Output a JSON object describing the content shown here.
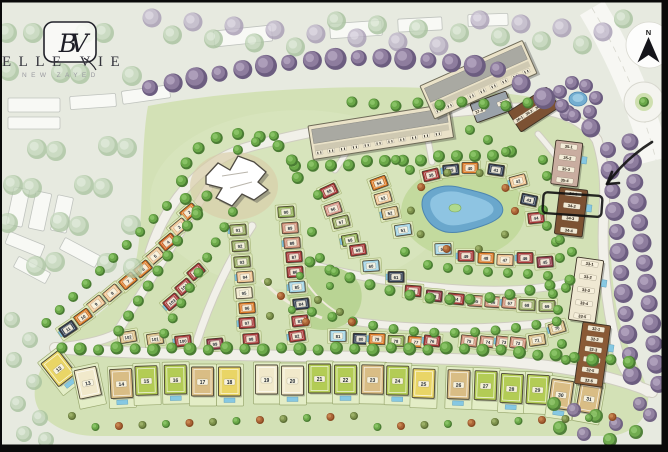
{
  "branding": {
    "title": "ELLE VIE",
    "subtitle": "NEW ZAYED",
    "monogram": "BV"
  },
  "compass": {
    "label": "N"
  },
  "annotation": {
    "highlighted_unit": "34-2"
  },
  "palette": {
    "orange": "#dd7a26",
    "orange2": "#d2601e",
    "peach": "#f0c491",
    "cream": "#f1e9cb",
    "tan": "#d9bd85",
    "yellow": "#e9d566",
    "lime": "#b3cc55",
    "green": "#8fae52",
    "olive": "#93a75d",
    "red": "#a83737",
    "maroon": "#8c3343",
    "salmon": "#cf8d74",
    "pink": "#d89486",
    "navy": "#2f3b4e",
    "blue": "#9fd2e4",
    "brown": "#7c5233"
  },
  "plots": [
    {
      "n": "2",
      "x": 189,
      "y": 212,
      "rot": -40,
      "c": "orange"
    },
    {
      "n": "3",
      "x": 179,
      "y": 227,
      "rot": -40,
      "c": "peach"
    },
    {
      "n": "4",
      "x": 168,
      "y": 242,
      "rot": -40,
      "c": "orange2"
    },
    {
      "n": "5",
      "x": 155,
      "y": 256,
      "rot": -40,
      "c": "peach"
    },
    {
      "n": "6",
      "x": 143,
      "y": 269,
      "rot": -40,
      "c": "orange"
    },
    {
      "n": "7",
      "x": 128,
      "y": 281,
      "rot": -40,
      "c": "orange"
    },
    {
      "n": "8",
      "x": 112,
      "y": 293,
      "rot": -40,
      "c": "peach"
    },
    {
      "n": "9",
      "x": 96,
      "y": 304,
      "rot": -38,
      "c": "peach"
    },
    {
      "n": "10",
      "x": 83,
      "y": 317,
      "rot": -36,
      "c": "orange"
    },
    {
      "n": "11",
      "x": 68,
      "y": 329,
      "rot": -34,
      "c": "navy"
    },
    {
      "n": "105",
      "x": 196,
      "y": 272,
      "rot": -40,
      "c": "red"
    },
    {
      "n": "104",
      "x": 184,
      "y": 287,
      "rot": -40,
      "c": "red"
    },
    {
      "n": "103",
      "x": 172,
      "y": 302,
      "rot": -40,
      "c": "red"
    },
    {
      "n": "102",
      "x": 128,
      "y": 337,
      "rot": -10,
      "c": "tan"
    },
    {
      "n": "101",
      "x": 155,
      "y": 339,
      "rot": -8,
      "c": "tan"
    },
    {
      "n": "100",
      "x": 183,
      "y": 341,
      "rot": -6,
      "c": "red"
    },
    {
      "n": "99",
      "x": 215,
      "y": 344,
      "rot": -5,
      "c": "maroon"
    },
    {
      "n": "98",
      "x": 251,
      "y": 339,
      "rot": -4,
      "c": "red"
    },
    {
      "n": "97",
      "x": 247,
      "y": 323,
      "rot": -4,
      "c": "red"
    },
    {
      "n": "96",
      "x": 247,
      "y": 308,
      "rot": -4,
      "c": "orange"
    },
    {
      "n": "95",
      "x": 244,
      "y": 293,
      "rot": -4,
      "c": "cream"
    },
    {
      "n": "94",
      "x": 245,
      "y": 277,
      "rot": -4,
      "c": "peach"
    },
    {
      "n": "93",
      "x": 242,
      "y": 262,
      "rot": -4,
      "c": "olive"
    },
    {
      "n": "92",
      "x": 240,
      "y": 246,
      "rot": -4,
      "c": "olive"
    },
    {
      "n": "91",
      "x": 238,
      "y": 230,
      "rot": -4,
      "c": "olive"
    },
    {
      "n": "90",
      "x": 286,
      "y": 212,
      "rot": -4,
      "c": "green"
    },
    {
      "n": "89",
      "x": 290,
      "y": 228,
      "rot": -4,
      "c": "salmon"
    },
    {
      "n": "88",
      "x": 292,
      "y": 243,
      "rot": -4,
      "c": "salmon"
    },
    {
      "n": "87",
      "x": 294,
      "y": 257,
      "rot": -4,
      "c": "red"
    },
    {
      "n": "86",
      "x": 295,
      "y": 272,
      "rot": -4,
      "c": "red"
    },
    {
      "n": "85",
      "x": 297,
      "y": 287,
      "rot": -4,
      "c": "blue"
    },
    {
      "n": "84",
      "x": 301,
      "y": 304,
      "rot": -6,
      "c": "navy"
    },
    {
      "n": "83",
      "x": 300,
      "y": 321,
      "rot": -6,
      "c": "red"
    },
    {
      "n": "82",
      "x": 297,
      "y": 336,
      "rot": -8,
      "c": "red"
    },
    {
      "n": "81",
      "x": 338,
      "y": 336,
      "rot": 0,
      "c": "blue"
    },
    {
      "n": "80",
      "x": 361,
      "y": 339,
      "rot": 2,
      "c": "navy"
    },
    {
      "n": "79",
      "x": 377,
      "y": 339,
      "rot": 2,
      "c": "orange"
    },
    {
      "n": "78",
      "x": 396,
      "y": 341,
      "rot": 2,
      "c": "green"
    },
    {
      "n": "77",
      "x": 416,
      "y": 342,
      "rot": 4,
      "c": "orange"
    },
    {
      "n": "76",
      "x": 432,
      "y": 341,
      "rot": 5,
      "c": "red"
    },
    {
      "n": "75",
      "x": 469,
      "y": 341,
      "rot": 6,
      "c": "salmon"
    },
    {
      "n": "74",
      "x": 488,
      "y": 342,
      "rot": 6,
      "c": "salmon"
    },
    {
      "n": "73",
      "x": 504,
      "y": 342,
      "rot": 6,
      "c": "salmon"
    },
    {
      "n": "72",
      "x": 518,
      "y": 343,
      "rot": 6,
      "c": "salmon"
    },
    {
      "n": "71",
      "x": 537,
      "y": 340,
      "rot": -8,
      "c": "tan"
    },
    {
      "n": "70",
      "x": 557,
      "y": 328,
      "rot": -16,
      "c": "tan"
    },
    {
      "n": "62",
      "x": 413,
      "y": 291,
      "rot": 4,
      "c": "red"
    },
    {
      "n": "63",
      "x": 434,
      "y": 296,
      "rot": 5,
      "c": "maroon"
    },
    {
      "n": "64",
      "x": 456,
      "y": 299,
      "rot": 5,
      "c": "red"
    },
    {
      "n": "65",
      "x": 476,
      "y": 301,
      "rot": 4,
      "c": "salmon"
    },
    {
      "n": "66",
      "x": 493,
      "y": 302,
      "rot": 4,
      "c": "salmon"
    },
    {
      "n": "67",
      "x": 510,
      "y": 303,
      "rot": 4,
      "c": "salmon"
    },
    {
      "n": "68",
      "x": 527,
      "y": 305,
      "rot": 2,
      "c": "olive"
    },
    {
      "n": "69",
      "x": 547,
      "y": 306,
      "rot": 0,
      "c": "olive"
    },
    {
      "n": "55",
      "x": 329,
      "y": 191,
      "rot": -25,
      "c": "red"
    },
    {
      "n": "56",
      "x": 333,
      "y": 209,
      "rot": -18,
      "c": "pink"
    },
    {
      "n": "57",
      "x": 341,
      "y": 222,
      "rot": -14,
      "c": "olive"
    },
    {
      "n": "58",
      "x": 350,
      "y": 240,
      "rot": -10,
      "c": "green"
    },
    {
      "n": "59",
      "x": 358,
      "y": 250,
      "rot": -8,
      "c": "red"
    },
    {
      "n": "60",
      "x": 371,
      "y": 266,
      "rot": -4,
      "c": "blue"
    },
    {
      "n": "61",
      "x": 396,
      "y": 277,
      "rot": 0,
      "c": "navy"
    },
    {
      "n": "54",
      "x": 379,
      "y": 183,
      "rot": -20,
      "c": "orange"
    },
    {
      "n": "53",
      "x": 383,
      "y": 198,
      "rot": -16,
      "c": "peach"
    },
    {
      "n": "52",
      "x": 390,
      "y": 213,
      "rot": -12,
      "c": "tan"
    },
    {
      "n": "51",
      "x": 403,
      "y": 230,
      "rot": -8,
      "c": "blue"
    },
    {
      "n": "50",
      "x": 443,
      "y": 249,
      "rot": -2,
      "c": "blue"
    },
    {
      "n": "49",
      "x": 466,
      "y": 256,
      "rot": 0,
      "c": "red"
    },
    {
      "n": "48",
      "x": 486,
      "y": 258,
      "rot": 2,
      "c": "orange"
    },
    {
      "n": "47",
      "x": 505,
      "y": 260,
      "rot": 2,
      "c": "peach"
    },
    {
      "n": "46",
      "x": 525,
      "y": 258,
      "rot": 0,
      "c": "red"
    },
    {
      "n": "45",
      "x": 545,
      "y": 262,
      "rot": -4,
      "c": "maroon"
    },
    {
      "n": "38",
      "x": 431,
      "y": 175,
      "rot": -14,
      "c": "red"
    },
    {
      "n": "39",
      "x": 451,
      "y": 170,
      "rot": -6,
      "c": "navy"
    },
    {
      "n": "40",
      "x": 470,
      "y": 168,
      "rot": 0,
      "c": "orange"
    },
    {
      "n": "41",
      "x": 496,
      "y": 170,
      "rot": 8,
      "c": "navy"
    },
    {
      "n": "42",
      "x": 518,
      "y": 181,
      "rot": -15,
      "c": "peach"
    },
    {
      "n": "43",
      "x": 529,
      "y": 200,
      "rot": 12,
      "c": "navy"
    },
    {
      "n": "44",
      "x": 536,
      "y": 218,
      "rot": -6,
      "c": "red"
    }
  ],
  "villas": [
    {
      "n": "12",
      "x": 61,
      "y": 371,
      "rot": -38,
      "c": "yellow"
    },
    {
      "n": "13",
      "x": 89,
      "y": 386,
      "rot": -12,
      "c": "cream"
    },
    {
      "n": "14",
      "x": 122,
      "y": 387,
      "rot": -3,
      "c": "tan"
    },
    {
      "n": "15",
      "x": 147,
      "y": 384,
      "rot": -2,
      "c": "lime"
    },
    {
      "n": "16",
      "x": 176,
      "y": 383,
      "rot": -1,
      "c": "lime"
    },
    {
      "n": "17",
      "x": 203,
      "y": 385,
      "rot": 0,
      "c": "tan"
    },
    {
      "n": "18",
      "x": 230,
      "y": 385,
      "rot": 0,
      "c": "yellow"
    },
    {
      "n": "19",
      "x": 267,
      "y": 383,
      "rot": 0,
      "c": "cream"
    },
    {
      "n": "20",
      "x": 293,
      "y": 384,
      "rot": 0,
      "c": "cream"
    },
    {
      "n": "21",
      "x": 320,
      "y": 382,
      "rot": 0,
      "c": "lime"
    },
    {
      "n": "22",
      "x": 346,
      "y": 383,
      "rot": 0,
      "c": "lime"
    },
    {
      "n": "23",
      "x": 373,
      "y": 383,
      "rot": 1,
      "c": "tan"
    },
    {
      "n": "24",
      "x": 398,
      "y": 384,
      "rot": 1,
      "c": "lime"
    },
    {
      "n": "25",
      "x": 424,
      "y": 387,
      "rot": 2,
      "c": "yellow"
    },
    {
      "n": "26",
      "x": 459,
      "y": 388,
      "rot": 2,
      "c": "tan"
    },
    {
      "n": "27",
      "x": 486,
      "y": 389,
      "rot": 2,
      "c": "lime"
    },
    {
      "n": "28",
      "x": 512,
      "y": 392,
      "rot": 3,
      "c": "lime"
    },
    {
      "n": "29",
      "x": 538,
      "y": 393,
      "rot": 3,
      "c": "lime"
    },
    {
      "n": "30",
      "x": 561,
      "y": 398,
      "rot": 8,
      "c": "tan"
    },
    {
      "n": "31",
      "x": 589,
      "y": 402,
      "rot": 10,
      "c": "tan"
    }
  ],
  "buildings": [
    {
      "name": "37",
      "x": 470,
      "y": 104,
      "w": 38,
      "h": 20,
      "rot": -20,
      "c": "#9aa2aa",
      "along": "x",
      "units": [
        "37-4",
        "37-5"
      ]
    },
    {
      "name": "36",
      "x": 508,
      "y": 112,
      "w": 46,
      "h": 24,
      "rot": -33,
      "c": "#7c5233",
      "along": "x",
      "units": [
        "36-1",
        "36-2",
        "36-3",
        "36-4"
      ]
    },
    {
      "name": "35",
      "x": 556,
      "y": 140,
      "w": 27,
      "h": 44,
      "rot": 7,
      "c": "#c9ada0",
      "along": "y",
      "units": [
        "35-1",
        "35-2",
        "35-3",
        "35-4"
      ]
    },
    {
      "name": "34",
      "x": 560,
      "y": 187,
      "w": 28,
      "h": 47,
      "rot": 7,
      "c": "#7c5233",
      "along": "y",
      "units": [
        "34-1",
        "34-2",
        "34-3",
        "34-4"
      ]
    },
    {
      "name": "33",
      "x": 577,
      "y": 257,
      "w": 27,
      "h": 63,
      "rot": 8,
      "c": "#efe8d2",
      "along": "y",
      "units": [
        "33-1",
        "33-2",
        "33-3",
        "33-4",
        "33-5"
      ]
    },
    {
      "name": "32",
      "x": 583,
      "y": 322,
      "w": 28,
      "h": 62,
      "rot": 8,
      "c": "#8a5a36",
      "along": "y",
      "units": [
        "32-1",
        "32-2",
        "32-3",
        "32-4",
        "32-5",
        "32-6"
      ]
    }
  ],
  "condos": [
    {
      "x": 308,
      "y": 126,
      "w": 142,
      "h": 34,
      "rot": -9
    },
    {
      "x": 420,
      "y": 86,
      "w": 112,
      "h": 36,
      "rot": -24
    }
  ]
}
